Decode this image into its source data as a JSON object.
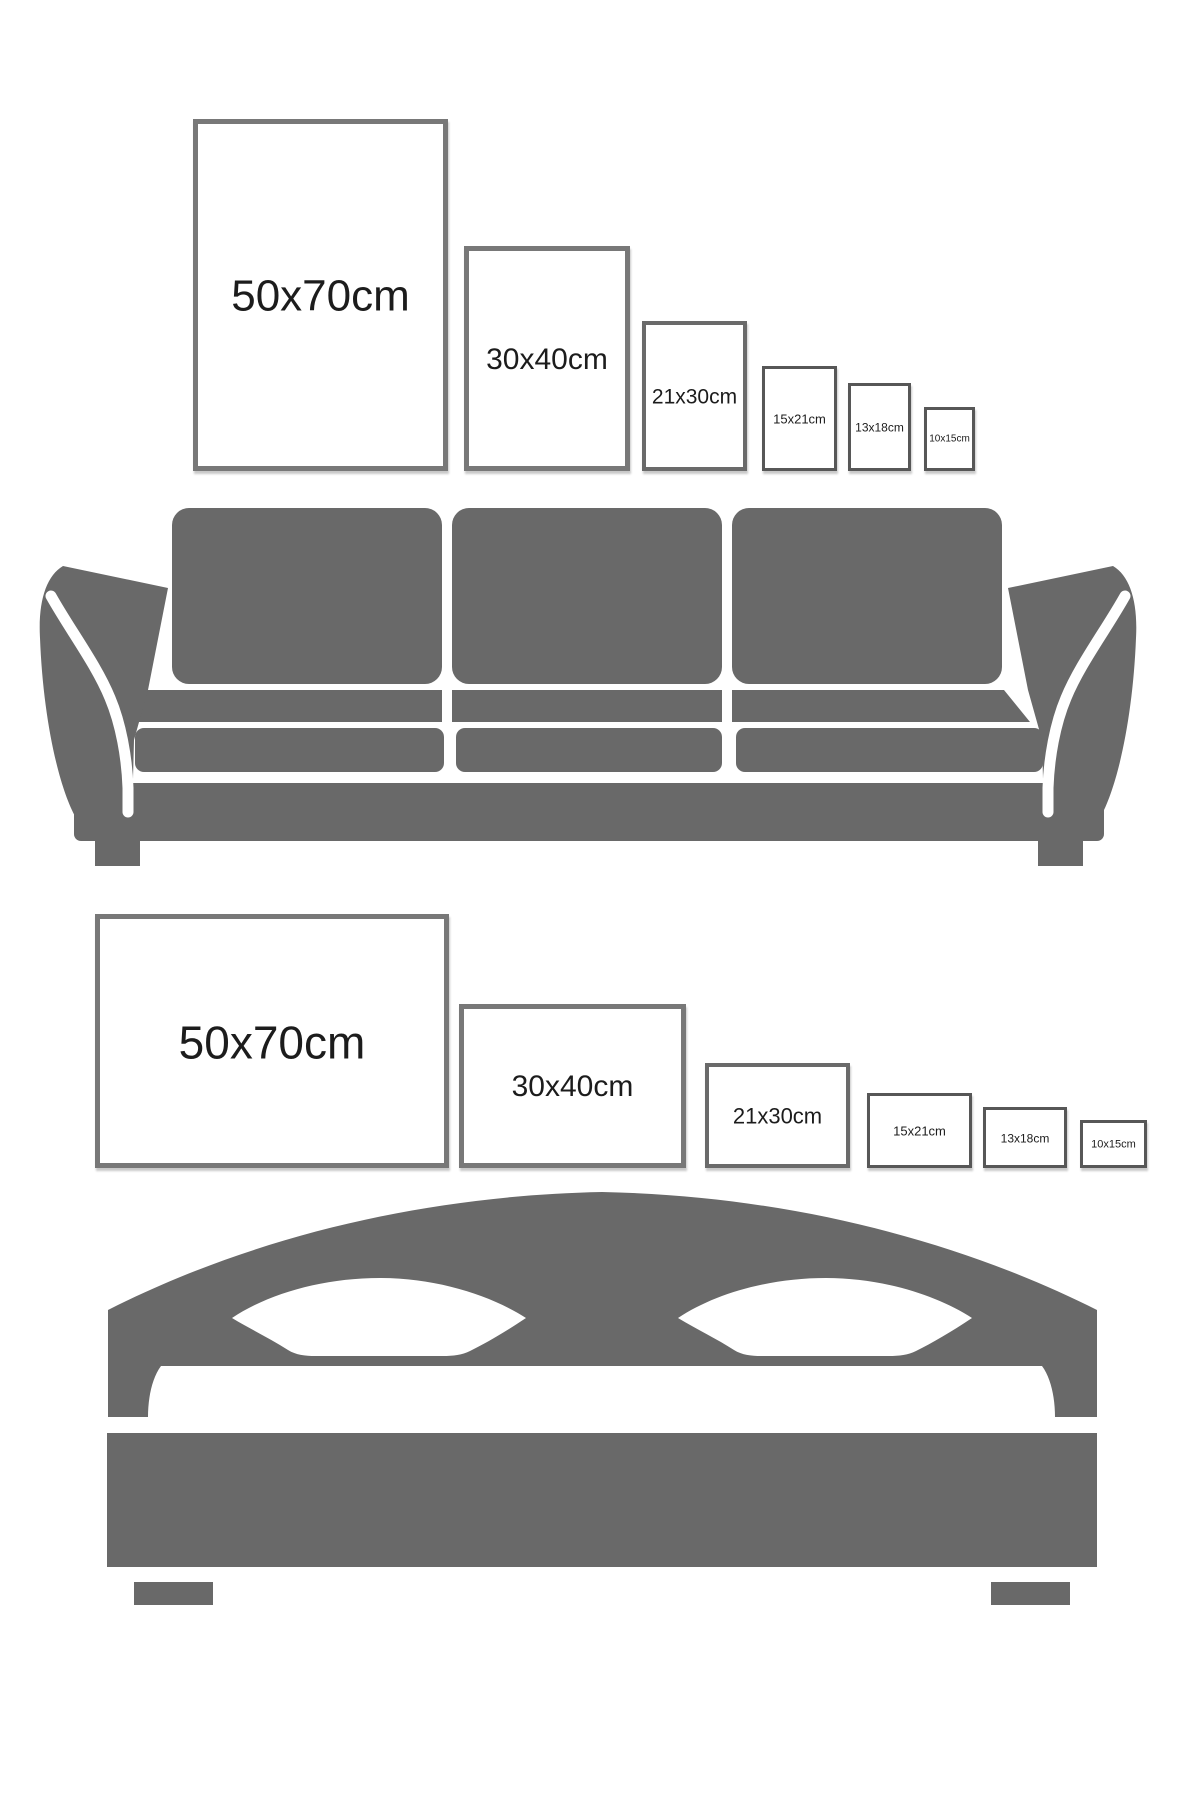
{
  "colors": {
    "background": "#ffffff",
    "furniture_gray": "#696969",
    "label_text": "#1c1c1c",
    "frame_border_large": "#787878",
    "frame_border_medium": "#6a6a6a",
    "frame_border_small": "#575757"
  },
  "wall_scene": {
    "illustration": "sofa",
    "frames": [
      {
        "size_label": "50x70cm"
      },
      {
        "size_label": "30x40cm"
      },
      {
        "size_label": "21x30cm"
      },
      {
        "size_label": "15x21cm"
      },
      {
        "size_label": "13x18cm"
      },
      {
        "size_label": "10x15cm"
      }
    ]
  },
  "bed_scene": {
    "illustration": "bed",
    "frames": [
      {
        "size_label": "50x70cm"
      },
      {
        "size_label": "30x40cm"
      },
      {
        "size_label": "21x30cm"
      },
      {
        "size_label": "15x21cm"
      },
      {
        "size_label": "13x18cm"
      },
      {
        "size_label": "10x15cm"
      }
    ]
  }
}
